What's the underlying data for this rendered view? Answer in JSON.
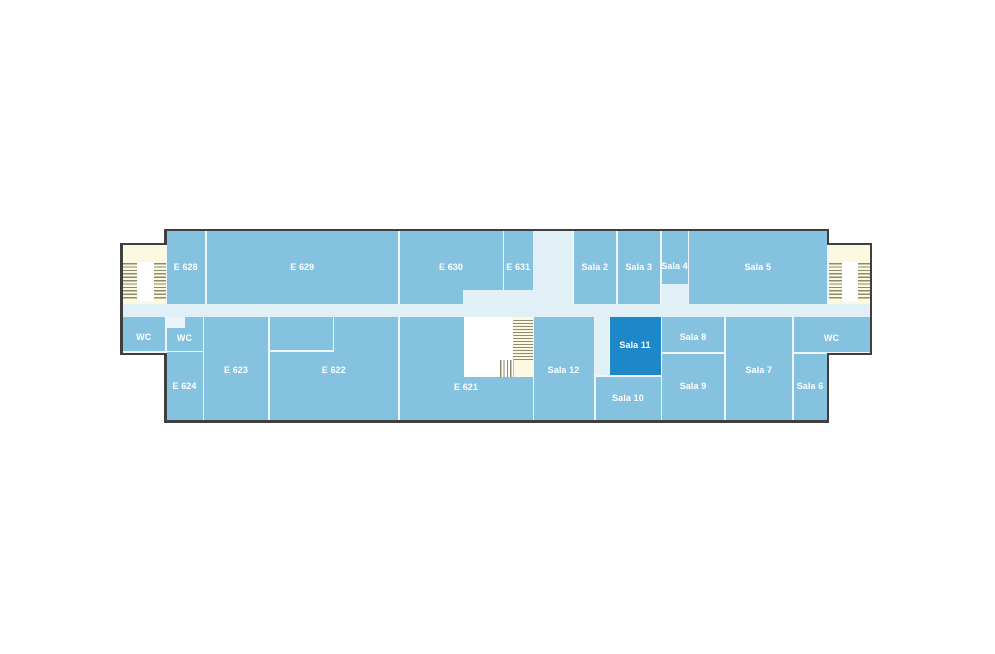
{
  "floorplan": {
    "description": "Building floor plan, sixth floor wing with rooms E 621 - E 631 and Sala 2 - Sala 12",
    "palette": {
      "room_fill": "#84c2e0",
      "highlighted_room_fill": "#1e87c8",
      "corridor_fill": "#e1eff7",
      "stairwell_fill": "#fcf8e2",
      "stair_tread": "#8c8b6e",
      "wall_outline": "#3f3f3f",
      "divider_line": "#eef6fb",
      "label_color": "#ffffff"
    },
    "highlighted_room": "Sala 11",
    "room_labels": [
      "E 628",
      "E 629",
      "E 630",
      "E 631",
      "Sala 2",
      "Sala 3",
      "Sala 4",
      "Sala 5",
      "WC",
      "WC",
      "E 624",
      "E 623",
      "E 622",
      "E 621",
      "Sala 12",
      "Sala 11",
      "Sala 10",
      "Sala 8",
      "Sala 9",
      "Sala 7",
      "WC",
      "Sala 6"
    ],
    "shapes": [
      {
        "name": "wall-main-body",
        "fill": "wall",
        "x": 164,
        "y": 228.5,
        "w": 665,
        "h": 194
      },
      {
        "name": "wall-left-wing",
        "fill": "wall",
        "x": 120,
        "y": 242.5,
        "w": 46,
        "h": 112
      },
      {
        "name": "wall-right-wing",
        "fill": "wall",
        "x": 827,
        "y": 242.5,
        "w": 45,
        "h": 112
      },
      {
        "name": "interior-base-main",
        "fill": "base",
        "x": 166.5,
        "y": 231,
        "w": 660,
        "h": 189
      },
      {
        "name": "interior-base-left-wing",
        "fill": "base",
        "x": 122.5,
        "y": 245,
        "w": 44,
        "h": 107.5
      },
      {
        "name": "interior-base-right-wing",
        "fill": "base",
        "x": 826.5,
        "y": 245,
        "w": 43,
        "h": 107.5
      },
      {
        "name": "left-stairwell",
        "fill": "cream",
        "x": 122.5,
        "y": 245,
        "w": 43,
        "h": 58.5
      },
      {
        "name": "right-stairwell",
        "fill": "cream",
        "x": 829,
        "y": 245,
        "w": 40.5,
        "h": 58.5
      },
      {
        "name": "left-stairwell-landing",
        "fill": "landing",
        "x": 137,
        "y": 261.5,
        "w": 16.5,
        "h": 39
      },
      {
        "name": "right-stairwell-landing",
        "fill": "landing",
        "x": 841.5,
        "y": 261.5,
        "w": 16.5,
        "h": 39
      },
      {
        "name": "left-stairs-treads-outer",
        "fill": "treads-h",
        "x": 123,
        "y": 263,
        "w": 14,
        "h": 36.5
      },
      {
        "name": "left-stairs-treads-inner",
        "fill": "treads-h",
        "x": 153.5,
        "y": 263,
        "w": 12,
        "h": 36.5
      },
      {
        "name": "right-stairs-treads-inner",
        "fill": "treads-h",
        "x": 829,
        "y": 263,
        "w": 12.5,
        "h": 36.5
      },
      {
        "name": "right-stairs-treads-outer",
        "fill": "treads-h",
        "x": 858,
        "y": 263,
        "w": 11.5,
        "h": 36.5
      },
      {
        "name": "room-e628",
        "fill": "room",
        "x": 166.5,
        "y": 231,
        "w": 38.5,
        "h": 72.5,
        "label": "E 628"
      },
      {
        "name": "room-e629",
        "fill": "room",
        "x": 206.5,
        "y": 231,
        "w": 191.5,
        "h": 72.5,
        "label": "E 629"
      },
      {
        "name": "room-e630",
        "fill": "room",
        "x": 399.5,
        "y": 231,
        "w": 103,
        "h": 72.5,
        "label": "E 630"
      },
      {
        "name": "room-e631",
        "fill": "room",
        "x": 504,
        "y": 231,
        "w": 28.5,
        "h": 72.5,
        "label": "E 631"
      },
      {
        "name": "room-sala2",
        "fill": "room",
        "x": 573.5,
        "y": 231,
        "w": 42.5,
        "h": 72.5,
        "label": "Sala 2"
      },
      {
        "name": "room-sala3",
        "fill": "room",
        "x": 617.5,
        "y": 231,
        "w": 42.5,
        "h": 72.5,
        "label": "Sala 3"
      },
      {
        "name": "room-sala4",
        "fill": "room",
        "x": 661.5,
        "y": 231,
        "w": 26,
        "h": 53,
        "label": "Sala 4",
        "dy": 9
      },
      {
        "name": "room-sala5",
        "fill": "room",
        "x": 689,
        "y": 231,
        "w": 137.5,
        "h": 72.5,
        "label": "Sala 5"
      },
      {
        "name": "room-wc-left",
        "fill": "room",
        "x": 122.5,
        "y": 316.5,
        "w": 42.5,
        "h": 34.5,
        "label": "WC",
        "dy": 4
      },
      {
        "name": "room-wc-center",
        "fill": "room",
        "x": 166.5,
        "y": 316.5,
        "w": 36,
        "h": 34,
        "label": "WC",
        "dy": 5
      },
      {
        "name": "room-e624",
        "fill": "room",
        "x": 166.5,
        "y": 352,
        "w": 36,
        "h": 68,
        "label": "E 624"
      },
      {
        "name": "room-e623",
        "fill": "room",
        "x": 204,
        "y": 316.5,
        "w": 64,
        "h": 103.5,
        "label": "E 623",
        "dy": 2
      },
      {
        "name": "room-e622",
        "fill": "room",
        "x": 269.5,
        "y": 316.5,
        "w": 128.5,
        "h": 103.5,
        "label": "E 622",
        "dy": 2
      },
      {
        "name": "room-e621",
        "fill": "room",
        "x": 399.5,
        "y": 316.5,
        "w": 133,
        "h": 103.5,
        "label": "E 621",
        "dy": 19
      },
      {
        "name": "room-sala12",
        "fill": "room",
        "x": 533.5,
        "y": 316.5,
        "w": 60,
        "h": 103.5,
        "label": "Sala 12",
        "dy": 2
      },
      {
        "name": "room-sala11",
        "fill": "room dark",
        "x": 609.5,
        "y": 316.5,
        "w": 51,
        "h": 58,
        "label": "Sala 11"
      },
      {
        "name": "room-sala10",
        "fill": "room",
        "x": 595.5,
        "y": 376.5,
        "w": 65,
        "h": 43.5,
        "label": "Sala 10"
      },
      {
        "name": "room-sala8",
        "fill": "room",
        "x": 662,
        "y": 316.5,
        "w": 62,
        "h": 35.5,
        "label": "Sala 8",
        "dy": 3
      },
      {
        "name": "room-sala9",
        "fill": "room",
        "x": 662,
        "y": 353.5,
        "w": 62,
        "h": 66.5,
        "label": "Sala 9"
      },
      {
        "name": "room-sala7",
        "fill": "room",
        "x": 725.5,
        "y": 316.5,
        "w": 66.5,
        "h": 103.5,
        "label": "Sala 7",
        "dy": 2
      },
      {
        "name": "room-wc-right",
        "fill": "room",
        "x": 793.5,
        "y": 316.5,
        "w": 76,
        "h": 35.5,
        "label": "WC",
        "dy": 4
      },
      {
        "name": "room-sala6",
        "fill": "room",
        "x": 793.5,
        "y": 353.5,
        "w": 33,
        "h": 66.5,
        "label": "Sala 6"
      },
      {
        "name": "corridor-main",
        "fill": "corridor",
        "x": 122.5,
        "y": 303.5,
        "w": 747,
        "h": 13
      },
      {
        "name": "corridor-vertical",
        "fill": "corridor",
        "x": 532.5,
        "y": 231,
        "w": 39.5,
        "h": 85.5
      },
      {
        "name": "corridor-notch-e630",
        "fill": "corridor",
        "x": 463,
        "y": 290,
        "w": 69.5,
        "h": 13.5
      },
      {
        "name": "corridor-notch-sala4",
        "fill": "corridor",
        "x": 661.5,
        "y": 284,
        "w": 26,
        "h": 19.5
      },
      {
        "name": "corridor-spur-sala11",
        "fill": "corridor",
        "x": 595,
        "y": 316.5,
        "w": 13.5,
        "h": 58
      },
      {
        "name": "wc-entrance-recess",
        "fill": "recess",
        "x": 166.5,
        "y": 316.5,
        "w": 18,
        "h": 11.5
      },
      {
        "name": "e621-stairwell-landing",
        "fill": "landing",
        "x": 463.5,
        "y": 316.5,
        "w": 49.5,
        "h": 60
      },
      {
        "name": "e621-stairwell",
        "fill": "cream",
        "x": 513,
        "y": 316.5,
        "w": 19.5,
        "h": 60
      },
      {
        "name": "e621-stairs-treads-horizontal",
        "fill": "treads-h dense",
        "x": 513,
        "y": 320,
        "w": 19.5,
        "h": 39.5
      },
      {
        "name": "e621-stairs-treads-vertical",
        "fill": "treads-v",
        "x": 499.5,
        "y": 360,
        "w": 14,
        "h": 16.5
      },
      {
        "name": "e622-partition-line-vertical",
        "fill": "base",
        "x": 332.5,
        "y": 316.5,
        "w": 1.5,
        "h": 35
      },
      {
        "name": "e622-partition-line-horizontal",
        "fill": "base",
        "x": 269.5,
        "y": 350,
        "w": 64.5,
        "h": 1.5
      }
    ]
  }
}
